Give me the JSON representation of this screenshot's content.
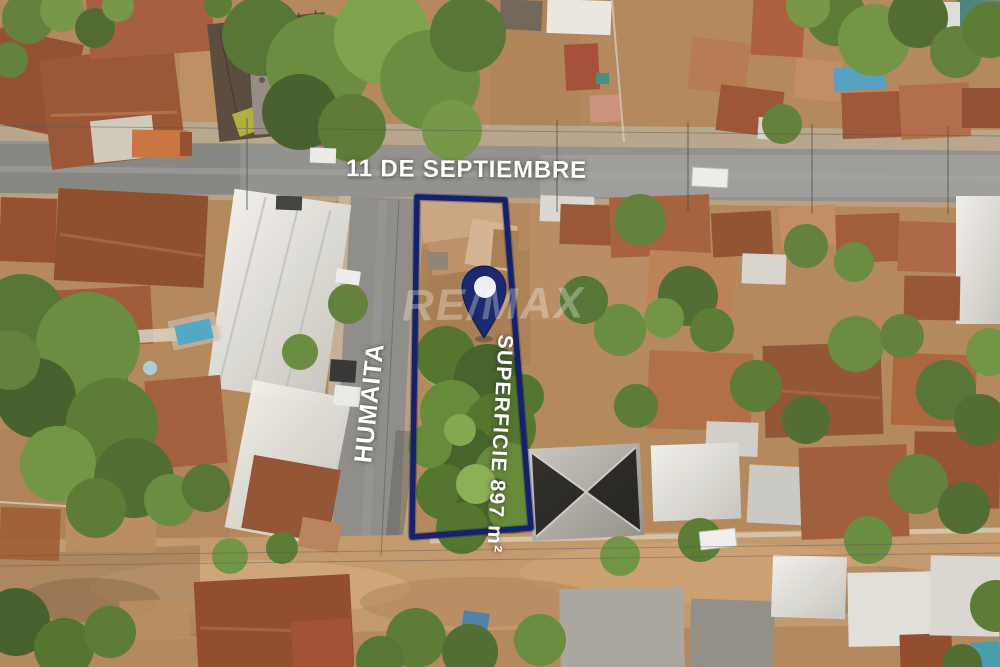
{
  "labels": {
    "street_top": "11 DE SEPTIEMBRE",
    "street_left": "HUMAITA",
    "area": "SUPERFICIE 897 m²",
    "watermark": "RE/MAX"
  },
  "icons": {
    "pin": "location-pin-icon"
  },
  "colors": {
    "annotation": "#15226b",
    "annotation_glow": "#0e1850",
    "pin": "#1b2a6e",
    "pin_hole": "#edeff4",
    "label_text": "#ffffff"
  }
}
